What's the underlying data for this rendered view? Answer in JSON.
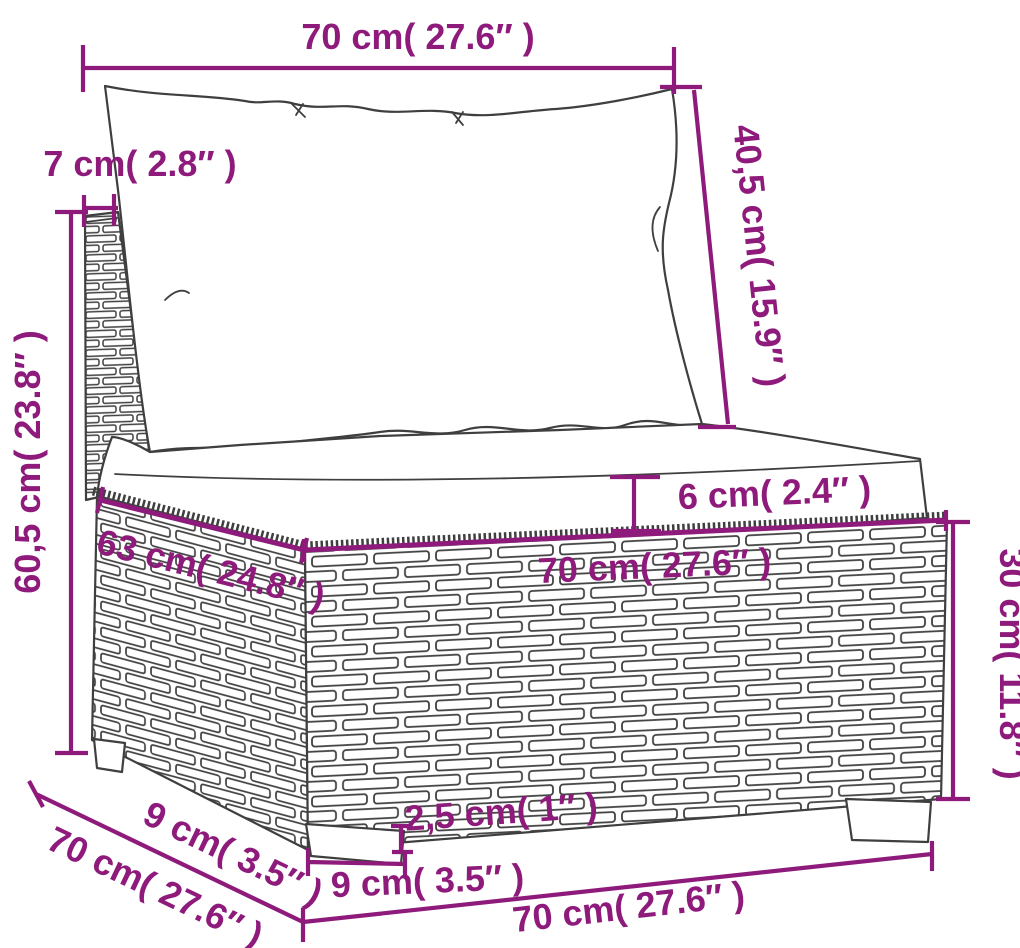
{
  "figure": {
    "kind": "furniture dimension diagram",
    "subject": "wicker sofa section with back cushion and seat cushion",
    "accent_color": "#8e1b7b",
    "line_color": "#3f3f3f",
    "background": "#ffffff"
  },
  "dims": {
    "back_width": "70 cm( 27.6″ )",
    "back_thickness": "7 cm( 2.8″ )",
    "back_cushion_height": "40,5 cm( 15.9″ )",
    "overall_height": "60,5 cm( 23.8″ )",
    "seat_cushion_thickness": "6 cm( 2.4″ )",
    "seat_width": "70 cm( 27.6″ )",
    "seat_depth": "63 cm( 24.8″ )",
    "base_height": "30 cm( 11.8″ )",
    "overall_depth": "70 cm( 27.6″ )",
    "leg_offset": "9 cm( 3.5″ )",
    "leg_width": "9 cm( 3.5″ )",
    "leg_height": "2,5 cm( 1″ )",
    "overall_width": "70 cm( 27.6″ )"
  }
}
